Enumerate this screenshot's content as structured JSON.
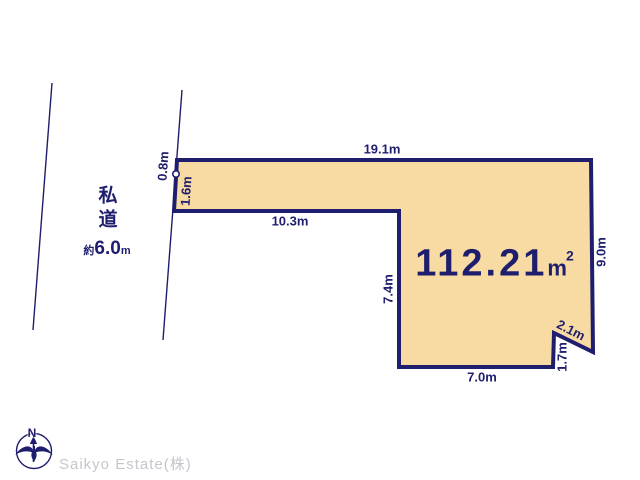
{
  "diagram": {
    "colors": {
      "outline": "#1f1e6e",
      "plot_fill": "#f8dba2",
      "watermark": "#c6c6cd"
    },
    "road": {
      "label": "私道",
      "width_prefix": "約",
      "width_value": "6.0",
      "width_unit": "m"
    },
    "plot": {
      "area_value": "112.21",
      "area_unit": "m",
      "area_sup": "2",
      "dimensions": {
        "top_edge": "19.1m",
        "upper_left_a": "0.8m",
        "upper_left_b": "1.6m",
        "strip_bottom_edge": "10.3m",
        "mid_left_edge": "7.4m",
        "right_edge": "9.0m",
        "notch_diagonal": "2.1m",
        "notch_vertical": "1.7m",
        "bottom_edge": "7.0m"
      }
    },
    "compass": {
      "label": "N"
    },
    "watermark": "Saikyo Estate(株)"
  }
}
